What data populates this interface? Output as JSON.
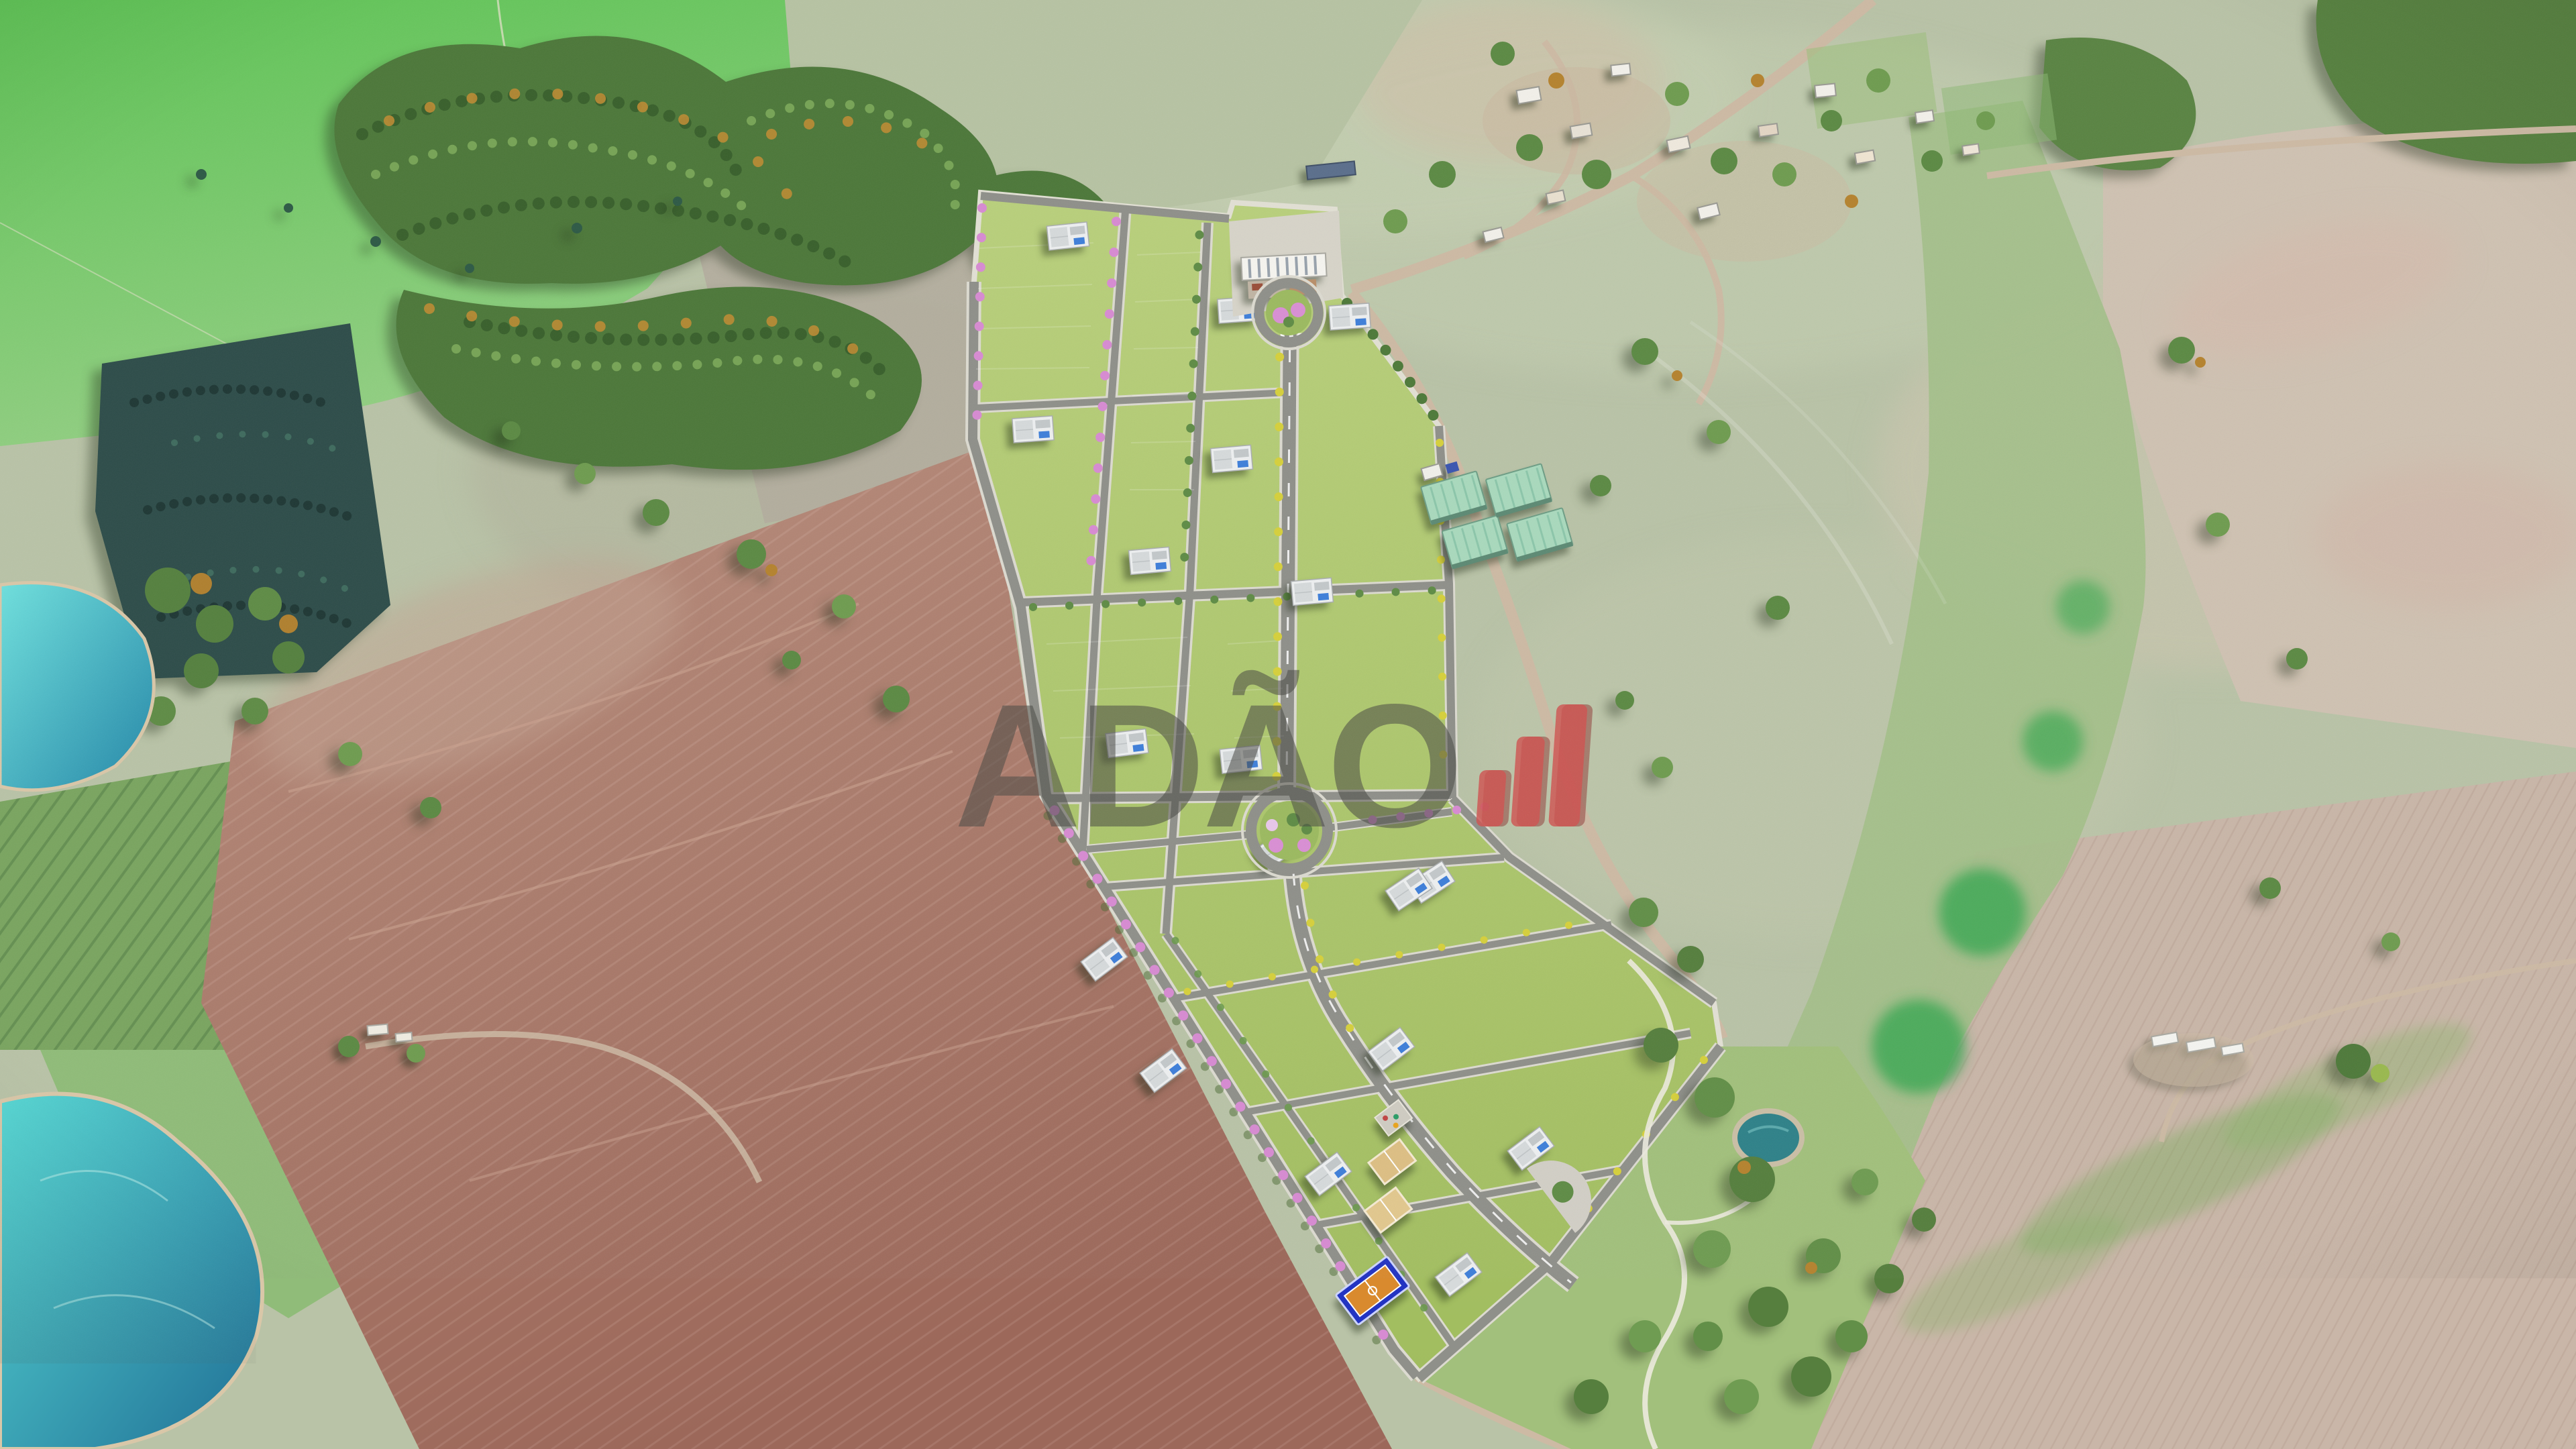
{
  "watermark": {
    "text": "ADÃO",
    "text_color": "#4a4a44",
    "text_opacity": 0.55,
    "logo_color": "#cf5350",
    "logo_shadow_color": "#8e3431",
    "logo_bar_count": 3
  },
  "palette": {
    "pasture_bright": "#5ec455",
    "pasture_pale": "#b9c3a7",
    "field_brown": "#ab8173",
    "field_brown_dark": "#9c685a",
    "field_beige": "#cfc2b2",
    "field_pink_rows": "#c9b6a8",
    "crop_green": "#7aa560",
    "wetland": "#a4bf8a",
    "emerald": "#3aa851",
    "forest": "#4d783a",
    "forest_dark": "#2e4d4a",
    "lake": "#4ccfd3",
    "lake_deep": "#1f6e95",
    "lawn": "#aec86d",
    "road": "#8f908a",
    "sidewalk": "#dcdad0",
    "dirt_road": "#cdbaa4",
    "tree_pink": "#d78bd2",
    "tree_yellow": "#d6d03c",
    "tree_green": "#5c8a44",
    "warehouse": "#a9d9bd",
    "court_blue": "#2334c2",
    "court_orange": "#d98a2e",
    "sand": "#e2c88e",
    "pond": "#2f8289",
    "house": "#edeff0",
    "portal": "#f5f4ef"
  }
}
